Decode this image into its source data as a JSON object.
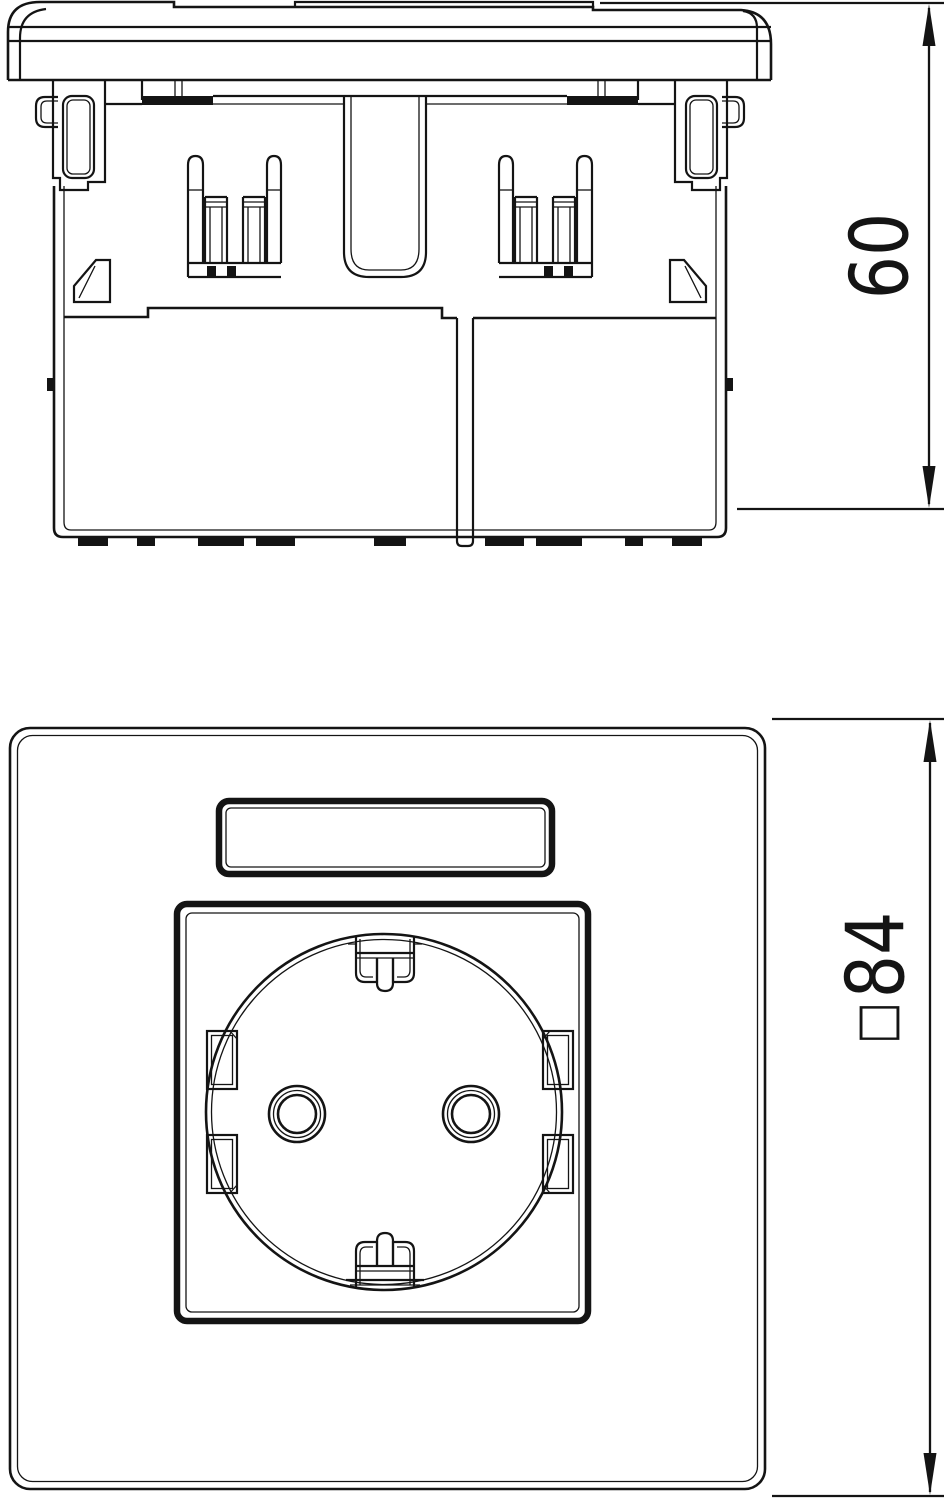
{
  "page": {
    "background": "#ffffff",
    "line_color": "#141414"
  },
  "drawing": {
    "kind": "technical-two-view-drawing",
    "views": {
      "side": {
        "name": "side-elevation"
      },
      "front": {
        "name": "front-view-socket-plate"
      }
    },
    "dimensions": {
      "depth": {
        "label": "60",
        "value": 60,
        "orientation": "vertical",
        "view": "side"
      },
      "front_size": {
        "symbol": "□",
        "label": "84",
        "value": 84,
        "orientation": "vertical",
        "view": "front"
      }
    }
  }
}
